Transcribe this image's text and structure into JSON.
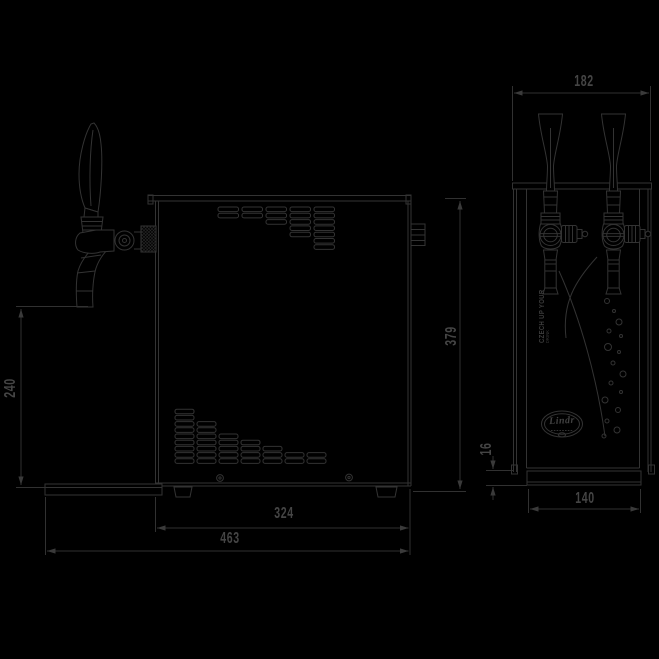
{
  "branding": {
    "logo_text": "Lindr",
    "slogan_line1": "CZECH UP YOUR",
    "slogan_line2": "DRINK"
  },
  "dimensions": {
    "side_tap_height": "240",
    "side_total_height": "379",
    "side_body_depth": "324",
    "side_total_depth": "463",
    "front_width": "182",
    "front_base_height": "16",
    "front_base_width": "140"
  }
}
